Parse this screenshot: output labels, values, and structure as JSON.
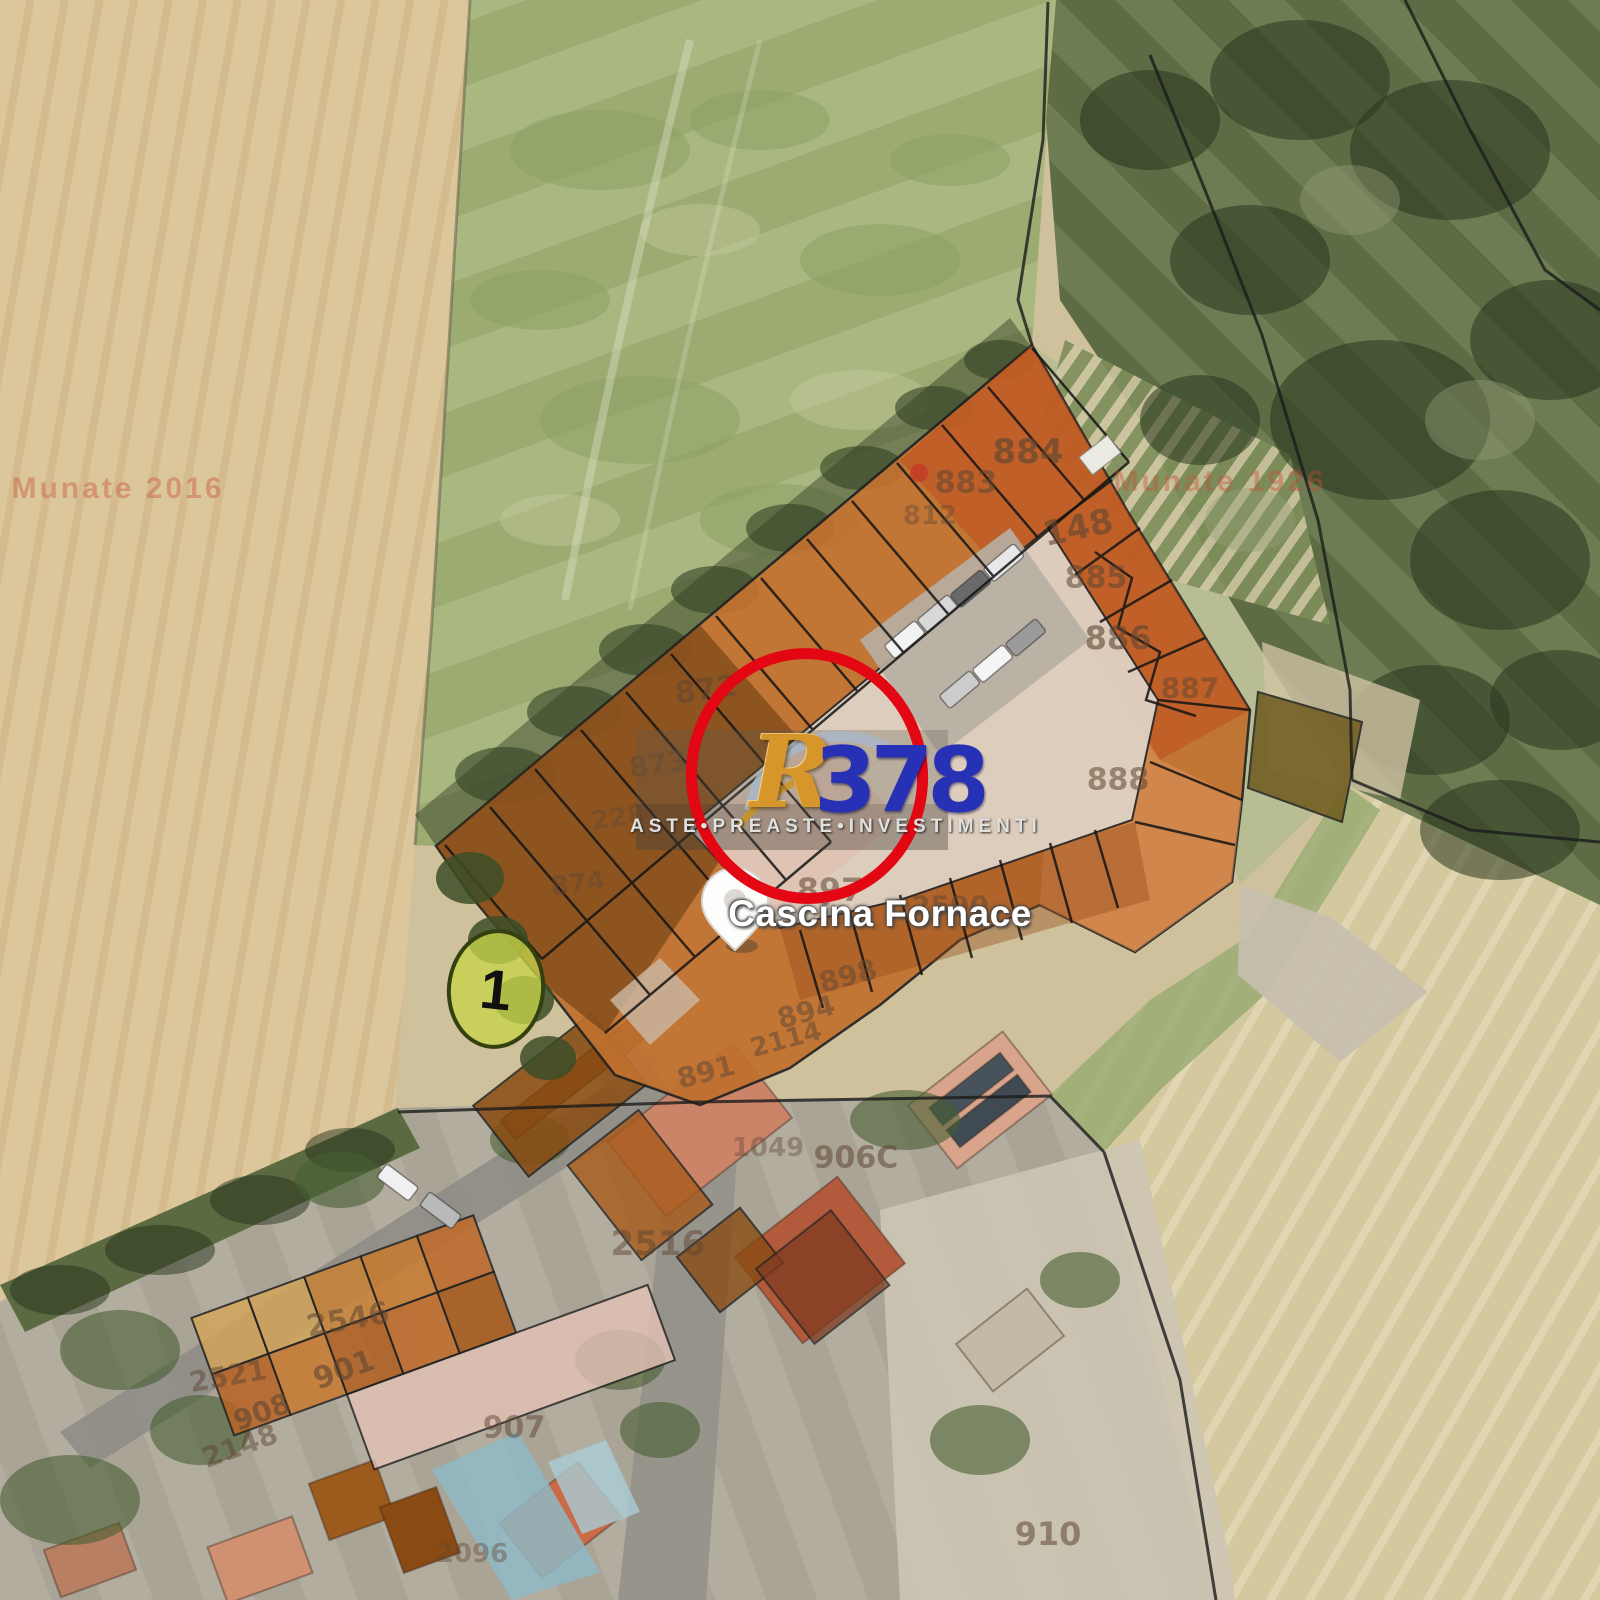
{
  "meta": {
    "type": "satellite-cadastral-map",
    "description": "Aerial photo of farmstead Cascina Fornace with orange cadastral parcel overlay, auction watermark and lot marker"
  },
  "map": {
    "place_label": "Cascina Fornace",
    "unit_marker": "1",
    "parcel_numbers": [
      {
        "num": "884",
        "x": 1028,
        "y": 452,
        "fs": 34,
        "rot": 0,
        "op": 0.65
      },
      {
        "num": "883",
        "x": 966,
        "y": 483,
        "fs": 30,
        "rot": 0,
        "op": 0.55
      },
      {
        "num": "812",
        "x": 930,
        "y": 516,
        "fs": 26,
        "rot": 0,
        "op": 0.4
      },
      {
        "num": "148",
        "x": 1078,
        "y": 528,
        "fs": 34,
        "rot": -12,
        "op": 0.6
      },
      {
        "num": "885",
        "x": 1096,
        "y": 578,
        "fs": 30,
        "rot": 0,
        "op": 0.55
      },
      {
        "num": "886",
        "x": 1118,
        "y": 638,
        "fs": 32,
        "rot": 0,
        "op": 0.6
      },
      {
        "num": "887",
        "x": 1190,
        "y": 688,
        "fs": 28,
        "rot": 0,
        "op": 0.5
      },
      {
        "num": "888",
        "x": 1118,
        "y": 780,
        "fs": 30,
        "rot": 0,
        "op": 0.55
      },
      {
        "num": "872",
        "x": 706,
        "y": 690,
        "fs": 30,
        "rot": -8,
        "op": 0.5
      },
      {
        "num": "873",
        "x": 658,
        "y": 764,
        "fs": 28,
        "rot": -8,
        "op": 0.45
      },
      {
        "num": "228",
        "x": 618,
        "y": 818,
        "fs": 26,
        "rot": -8,
        "op": 0.4
      },
      {
        "num": "874",
        "x": 578,
        "y": 884,
        "fs": 26,
        "rot": -8,
        "op": 0.45
      },
      {
        "num": "897",
        "x": 830,
        "y": 890,
        "fs": 32,
        "rot": 0,
        "op": 0.55
      },
      {
        "num": "2590",
        "x": 950,
        "y": 906,
        "fs": 28,
        "rot": 0,
        "op": 0.5
      },
      {
        "num": "898",
        "x": 848,
        "y": 976,
        "fs": 28,
        "rot": -15,
        "op": 0.5
      },
      {
        "num": "894",
        "x": 806,
        "y": 1012,
        "fs": 28,
        "rot": -15,
        "op": 0.5
      },
      {
        "num": "2114",
        "x": 786,
        "y": 1040,
        "fs": 26,
        "rot": -15,
        "op": 0.5
      },
      {
        "num": "891",
        "x": 706,
        "y": 1072,
        "fs": 28,
        "rot": -15,
        "op": 0.5
      },
      {
        "num": "1049",
        "x": 768,
        "y": 1148,
        "fs": 26,
        "rot": 0,
        "op": 0.4
      },
      {
        "num": "906C",
        "x": 856,
        "y": 1158,
        "fs": 30,
        "rot": 0,
        "op": 0.55
      },
      {
        "num": "2516",
        "x": 658,
        "y": 1244,
        "fs": 34,
        "rot": 0,
        "op": 0.5
      },
      {
        "num": "2546",
        "x": 348,
        "y": 1320,
        "fs": 30,
        "rot": -10,
        "op": 0.55
      },
      {
        "num": "901",
        "x": 344,
        "y": 1370,
        "fs": 30,
        "rot": -20,
        "op": 0.6
      },
      {
        "num": "2521",
        "x": 228,
        "y": 1376,
        "fs": 28,
        "rot": -10,
        "op": 0.5
      },
      {
        "num": "908",
        "x": 262,
        "y": 1412,
        "fs": 28,
        "rot": -20,
        "op": 0.6
      },
      {
        "num": "2148",
        "x": 240,
        "y": 1446,
        "fs": 28,
        "rot": -20,
        "op": 0.5
      },
      {
        "num": "907",
        "x": 514,
        "y": 1428,
        "fs": 30,
        "rot": 0,
        "op": 0.5
      },
      {
        "num": "910",
        "x": 1048,
        "y": 1534,
        "fs": 32,
        "rot": 0,
        "op": 0.55
      },
      {
        "num": "2096",
        "x": 472,
        "y": 1554,
        "fs": 26,
        "rot": 0,
        "op": 0.4
      }
    ],
    "faint_texts": [
      {
        "text": "Munate 2016",
        "x": 118,
        "y": 489,
        "fs": 30,
        "op": 0.38
      },
      {
        "text": "Munate 1926",
        "x": 1220,
        "y": 482,
        "fs": 30,
        "op": 0.38
      }
    ]
  },
  "watermark": {
    "letter": "R",
    "digits": "378",
    "tagline": "ASTE•PREASTE•INVESTIMENTI",
    "colors": {
      "circle": "#e30613",
      "letter": "#d6962a",
      "digits": "#2631b5",
      "tagline": "#e2e0dc"
    }
  },
  "palette": {
    "overlay_orange": "#c0702e",
    "wheat_field": "#dcc69b",
    "green_field": "#a7b57e",
    "woods": "#6d7c52",
    "marker_green": "#c6d449",
    "parcel_number_brown": "#5f4632"
  }
}
